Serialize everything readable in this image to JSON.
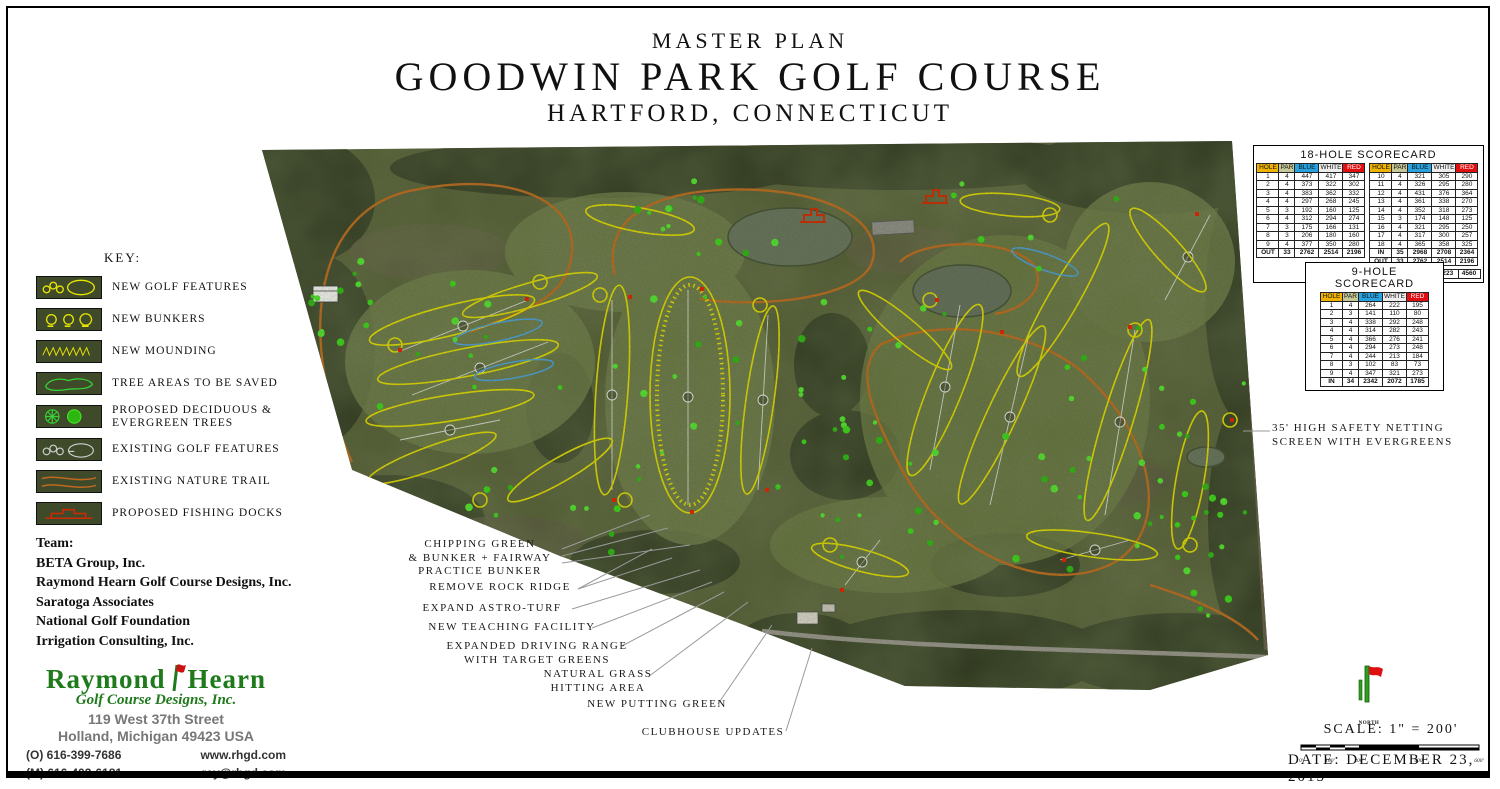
{
  "title": {
    "line1": "MASTER PLAN",
    "line2": "GOODWIN PARK GOLF COURSE",
    "line3": "HARTFORD, CONNECTICUT"
  },
  "key": {
    "heading": "KEY:",
    "items": [
      "NEW GOLF FEATURES",
      "NEW BUNKERS",
      "NEW MOUNDING",
      "TREE AREAS TO BE SAVED",
      "PROPOSED DECIDUOUS & EVERGREEN TREES",
      "EXISTING GOLF FEATURES",
      "EXISTING NATURE TRAIL",
      "PROPOSED FISHING DOCKS"
    ]
  },
  "team": {
    "heading": "Team:",
    "members": [
      "BETA Group, Inc.",
      "Raymond Hearn Golf Course Designs, Inc.",
      "Saratoga Associates",
      "National Golf Foundation",
      "Irrigation Consulting, Inc."
    ]
  },
  "logo": {
    "name_left": "Raymond",
    "name_right": "Hearn",
    "subtitle": "Golf Course Designs, Inc.",
    "address1": "119 West 37th Street",
    "address2": "Holland, Michigan 49423 USA",
    "phone_office": "(O) 616-399-7686",
    "phone_mobile": "(M) 616-403-6181",
    "website": "www.rhgd.com",
    "email": "ray@rhgd.com"
  },
  "scorecard18": {
    "title": "18-HOLE SCORECARD",
    "headers": [
      "HOLE",
      "PAR",
      "BLUE",
      "WHITE",
      "RED"
    ],
    "front": [
      [
        "1",
        "4",
        "447",
        "417",
        "347"
      ],
      [
        "2",
        "4",
        "373",
        "322",
        "302"
      ],
      [
        "3",
        "4",
        "383",
        "362",
        "332"
      ],
      [
        "4",
        "4",
        "297",
        "268",
        "245"
      ],
      [
        "5",
        "3",
        "192",
        "160",
        "125"
      ],
      [
        "6",
        "4",
        "312",
        "294",
        "274"
      ],
      [
        "7",
        "3",
        "175",
        "166",
        "131"
      ],
      [
        "8",
        "3",
        "206",
        "180",
        "160"
      ],
      [
        "9",
        "4",
        "377",
        "350",
        "280"
      ],
      [
        "OUT",
        "33",
        "2762",
        "2514",
        "2196"
      ]
    ],
    "back": [
      [
        "10",
        "4",
        "321",
        "305",
        "290"
      ],
      [
        "11",
        "4",
        "326",
        "295",
        "280"
      ],
      [
        "12",
        "4",
        "431",
        "376",
        "364"
      ],
      [
        "13",
        "4",
        "361",
        "338",
        "270"
      ],
      [
        "14",
        "4",
        "352",
        "318",
        "273"
      ],
      [
        "15",
        "3",
        "174",
        "148",
        "125"
      ],
      [
        "16",
        "4",
        "321",
        "295",
        "250"
      ],
      [
        "17",
        "4",
        "317",
        "300",
        "257"
      ],
      [
        "18",
        "4",
        "365",
        "358",
        "325"
      ],
      [
        "IN",
        "35",
        "2968",
        "2708",
        "2364"
      ],
      [
        "OUT",
        "33",
        "2762",
        "2514",
        "2196"
      ]
    ],
    "total": [
      [
        "TOTAL",
        "68",
        "5730",
        "5223",
        "4560"
      ]
    ]
  },
  "scorecard9": {
    "title": "9-HOLE SCORECARD",
    "headers": [
      "HOLE",
      "PAR",
      "BLUE",
      "WHITE",
      "RED"
    ],
    "rows": [
      [
        "1",
        "4",
        "264",
        "222",
        "195"
      ],
      [
        "2",
        "3",
        "141",
        "110",
        "80"
      ],
      [
        "3",
        "4",
        "338",
        "292",
        "248"
      ],
      [
        "4",
        "4",
        "314",
        "282",
        "243"
      ],
      [
        "5",
        "4",
        "366",
        "276",
        "241"
      ],
      [
        "6",
        "4",
        "294",
        "273",
        "248"
      ],
      [
        "7",
        "4",
        "244",
        "213",
        "184"
      ],
      [
        "8",
        "3",
        "102",
        "83",
        "73"
      ],
      [
        "9",
        "4",
        "347",
        "321",
        "273"
      ],
      [
        "IN",
        "34",
        "2342",
        "2072",
        "1785"
      ]
    ]
  },
  "annotations": [
    {
      "lines": [
        "CHIPPING GREEN",
        "& BUNKER + FAIRWAY",
        "PRACTICE BUNKER"
      ]
    },
    {
      "lines": [
        "REMOVE ROCK RIDGE"
      ]
    },
    {
      "lines": [
        "EXPAND ASTRO-TURF"
      ]
    },
    {
      "lines": [
        "NEW TEACHING FACILITY"
      ]
    },
    {
      "lines": [
        "EXPANDED DRIVING RANGE",
        "WITH TARGET GREENS"
      ]
    },
    {
      "lines": [
        "NATURAL GRASS",
        "HITTING AREA"
      ]
    },
    {
      "lines": [
        "NEW PUTTING GREEN"
      ]
    },
    {
      "lines": [
        "CLUBHOUSE UPDATES"
      ]
    }
  ],
  "note_right": {
    "lines": [
      "35' HIGH SAFETY NETTING",
      "SCREEN WITH EVERGREENS"
    ]
  },
  "north_label": "NORTH",
  "scale": {
    "label": "SCALE: 1\" = 200'",
    "ticks": [
      "0'",
      "100'",
      "200'",
      "400'",
      "600'"
    ]
  },
  "date": "DATE: DECEMBER 23, 2015",
  "colors": {
    "new_feature_yellow": "#ddd800",
    "saved_tree_green": "#35d435",
    "proposed_tree_green": "#3bd418",
    "nature_trail_orange": "#b96a1e",
    "fishing_dock_red": "#cc2a00",
    "header_hole_yellow": "#f0b400",
    "header_blue": "#29a3e0",
    "header_red": "#e01010",
    "logo_green": "#1e7a1a"
  }
}
